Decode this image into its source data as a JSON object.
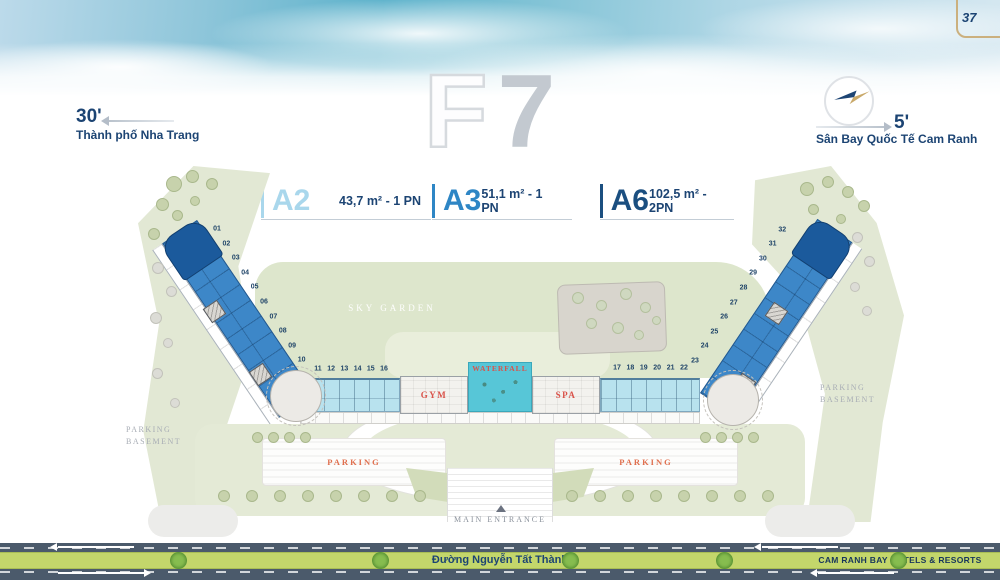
{
  "page": {
    "number": "37"
  },
  "header": {
    "floor": {
      "letter": "F",
      "digit": "7"
    },
    "left_landmark": {
      "minutes": "30'",
      "name": "Thành phố Nha Trang"
    },
    "right_landmark": {
      "minutes": "5'",
      "name": "Sân Bay Quốc Tế Cam Ranh"
    }
  },
  "legend": {
    "items": [
      {
        "code": "A2",
        "spec": "43,7 m² - 1 PN",
        "color": "#a9d7ec"
      },
      {
        "code": "A3",
        "spec": "51,1 m² - 1 PN",
        "color": "#2e86c5"
      },
      {
        "code": "A6",
        "spec": "102,5 m² - 2PN",
        "color": "#1b4f80"
      }
    ]
  },
  "plan": {
    "labels": {
      "sky_garden": "SKY GARDEN",
      "waterfall": "WATERFALL",
      "gym": "GYM",
      "spa": "SPA",
      "parking_left": "PARKING",
      "parking_right": "PARKING",
      "parking_basement_left": "PARKING BASEMENT",
      "parking_basement_right": "PARKING BASEMENT",
      "main_entrance": "MAIN ENTRANCE"
    },
    "units": {
      "left_wing": [
        "01",
        "02",
        "03",
        "04",
        "05",
        "06",
        "07",
        "08",
        "09",
        "10"
      ],
      "center_left": [
        "11",
        "12",
        "13",
        "14",
        "15",
        "16"
      ],
      "center_right": [
        "17",
        "18",
        "19",
        "20",
        "21",
        "22"
      ],
      "right_wing": [
        "23",
        "24",
        "25",
        "26",
        "27",
        "28",
        "29",
        "30",
        "31",
        "32"
      ]
    }
  },
  "road": {
    "street_name": "Đường Nguyễn Tất Thành",
    "brand": "CAM RANH BAY HOTELS & RESORTS"
  },
  "colors": {
    "navy": "#1c4473",
    "a2_fill": "#b8e2ee",
    "a3_fill": "#3d87c8",
    "a6_fill": "#1b5a9c",
    "waterfall": "#57c6d7",
    "accent_red": "#d9534a",
    "landscape_green": "#e0e7d0",
    "median_green": "#c3d66b",
    "road_gray": "#4b5a6b",
    "frame_gold": "#cbb07e"
  }
}
